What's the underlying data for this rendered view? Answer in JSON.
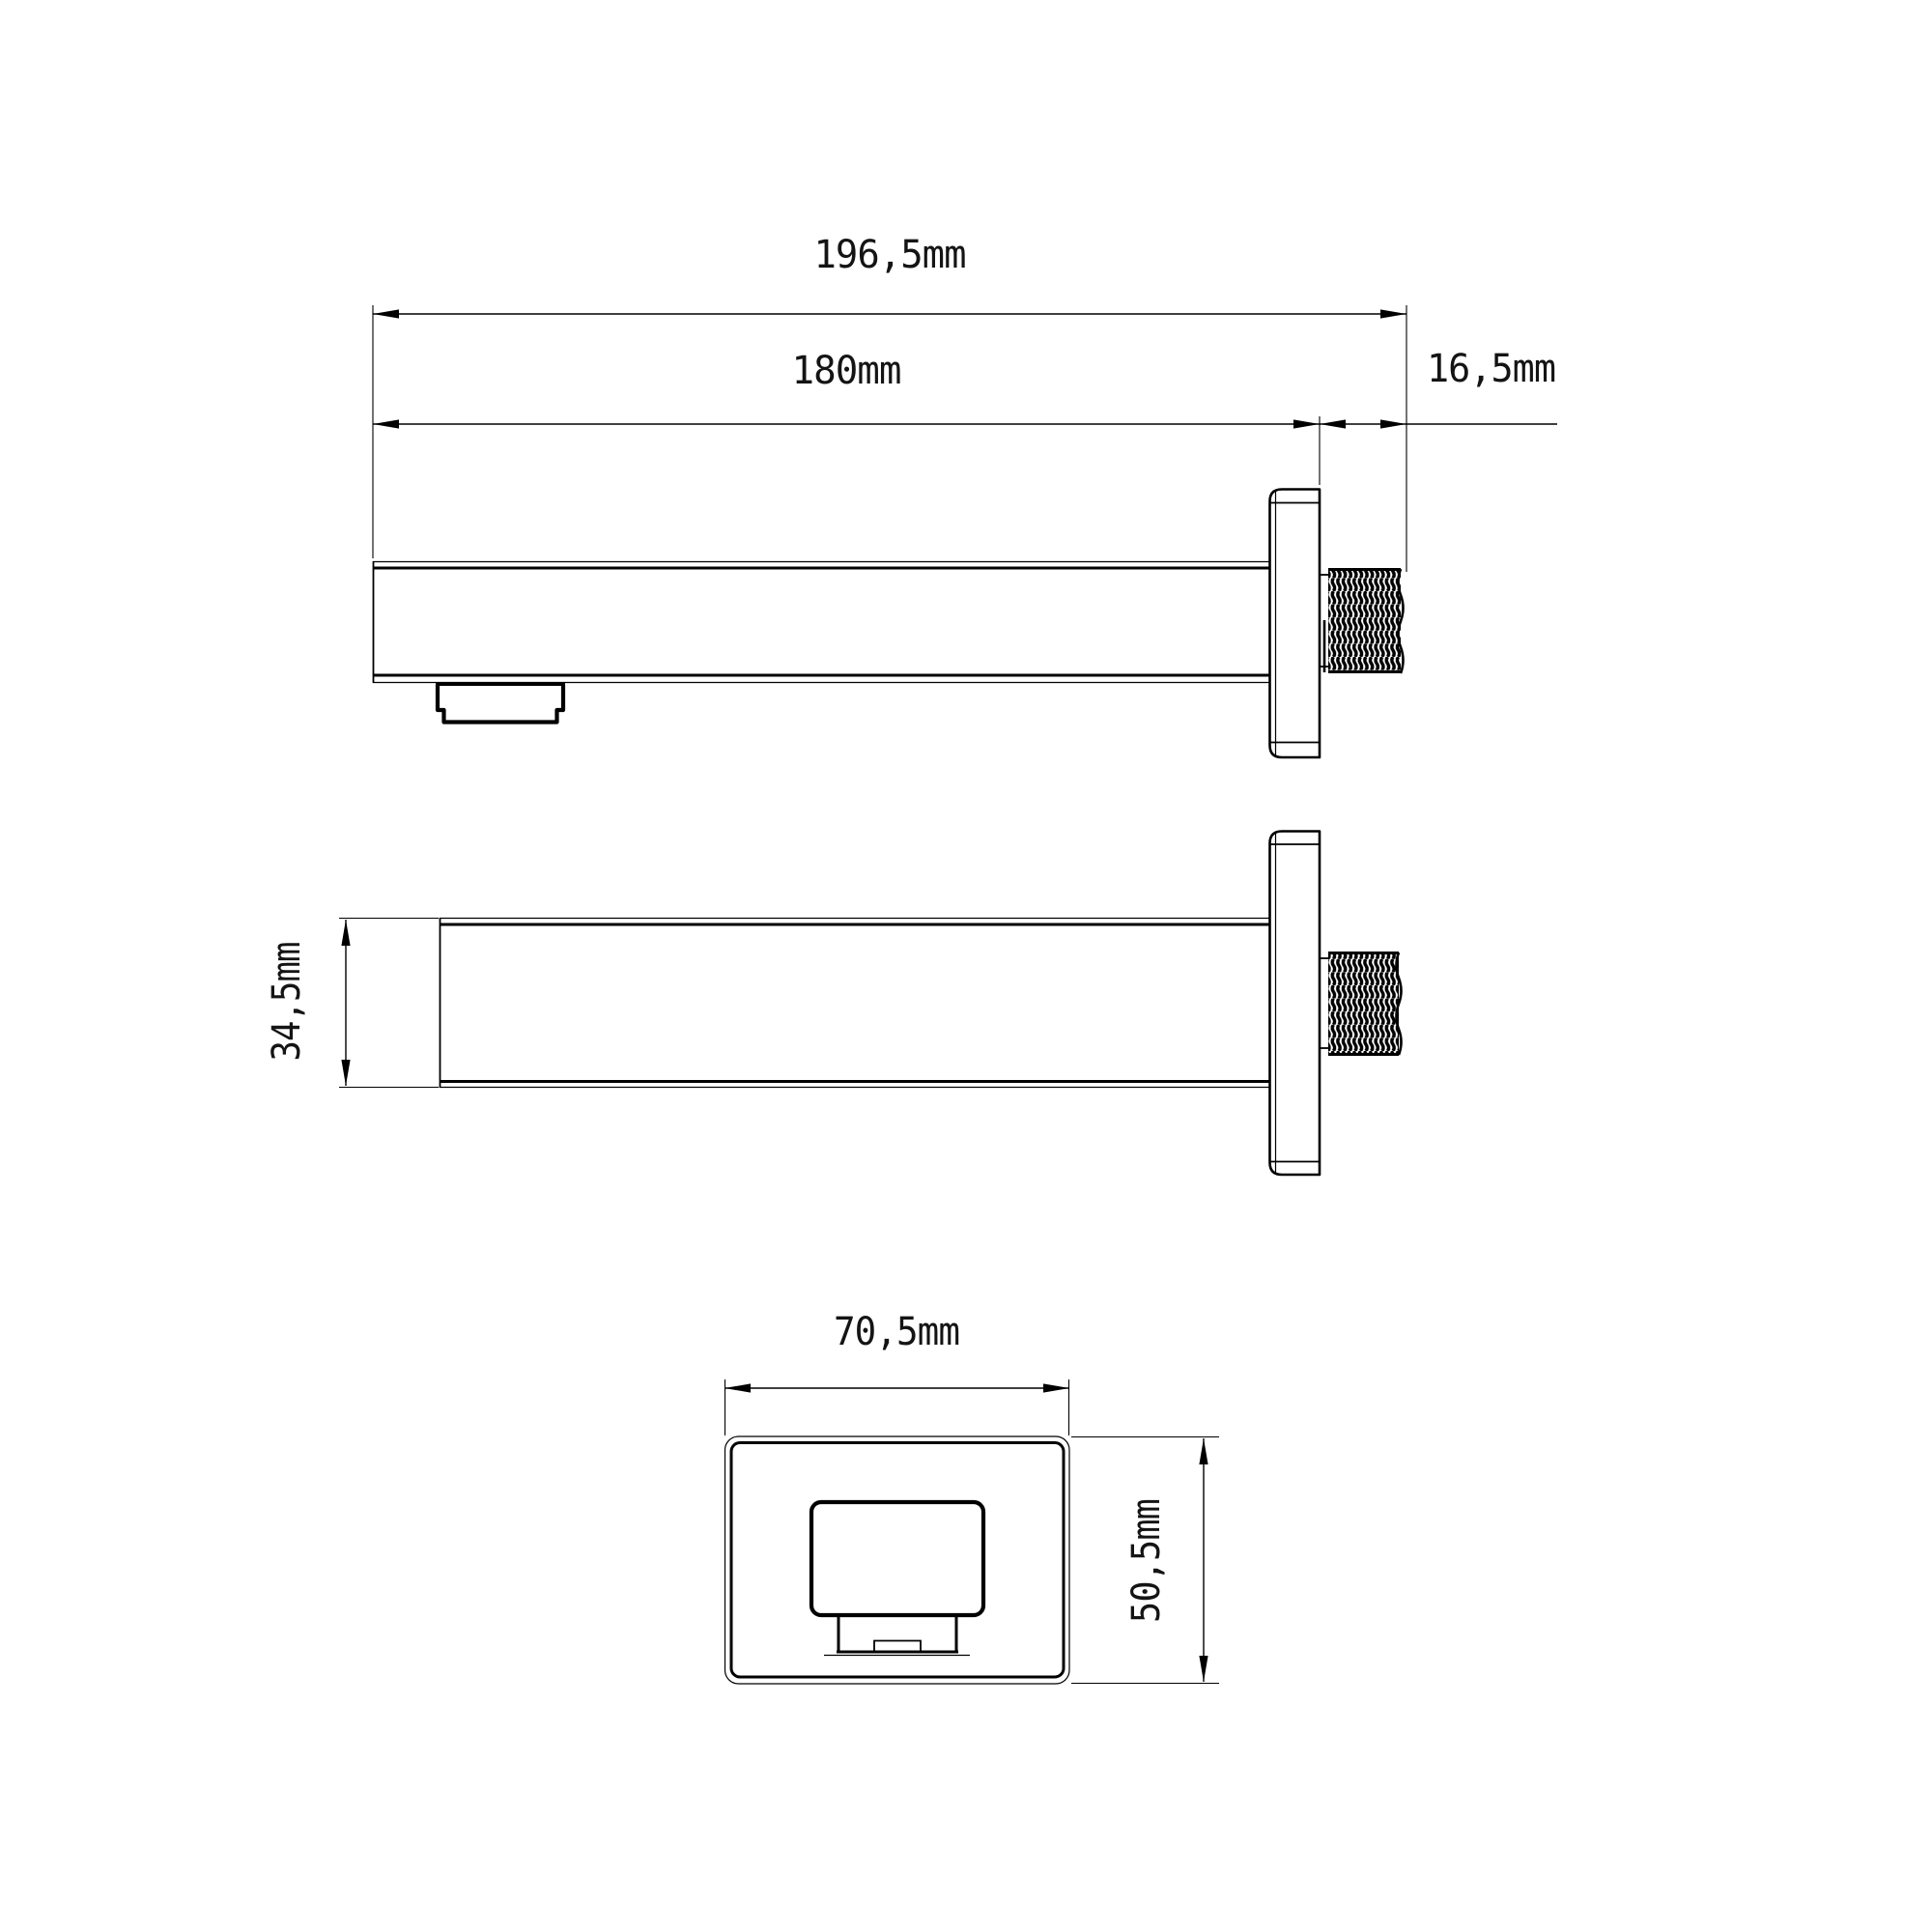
{
  "drawing": {
    "background_color": "#ffffff",
    "line_color": "#000000",
    "type": "technical-dimension-drawing",
    "subject": "wall-mounted square bath spout with flange and threaded connector",
    "views": {
      "side_view": {
        "dimensions": {
          "total_length": "196,5mm",
          "spout_length": "180mm",
          "thread_length": "16,5mm"
        }
      },
      "top_view": {
        "dimensions": {
          "spout_width": "34,5mm"
        }
      },
      "front_view": {
        "dimensions": {
          "plate_width": "70,5mm",
          "plate_height": "50,5mm"
        }
      }
    }
  }
}
